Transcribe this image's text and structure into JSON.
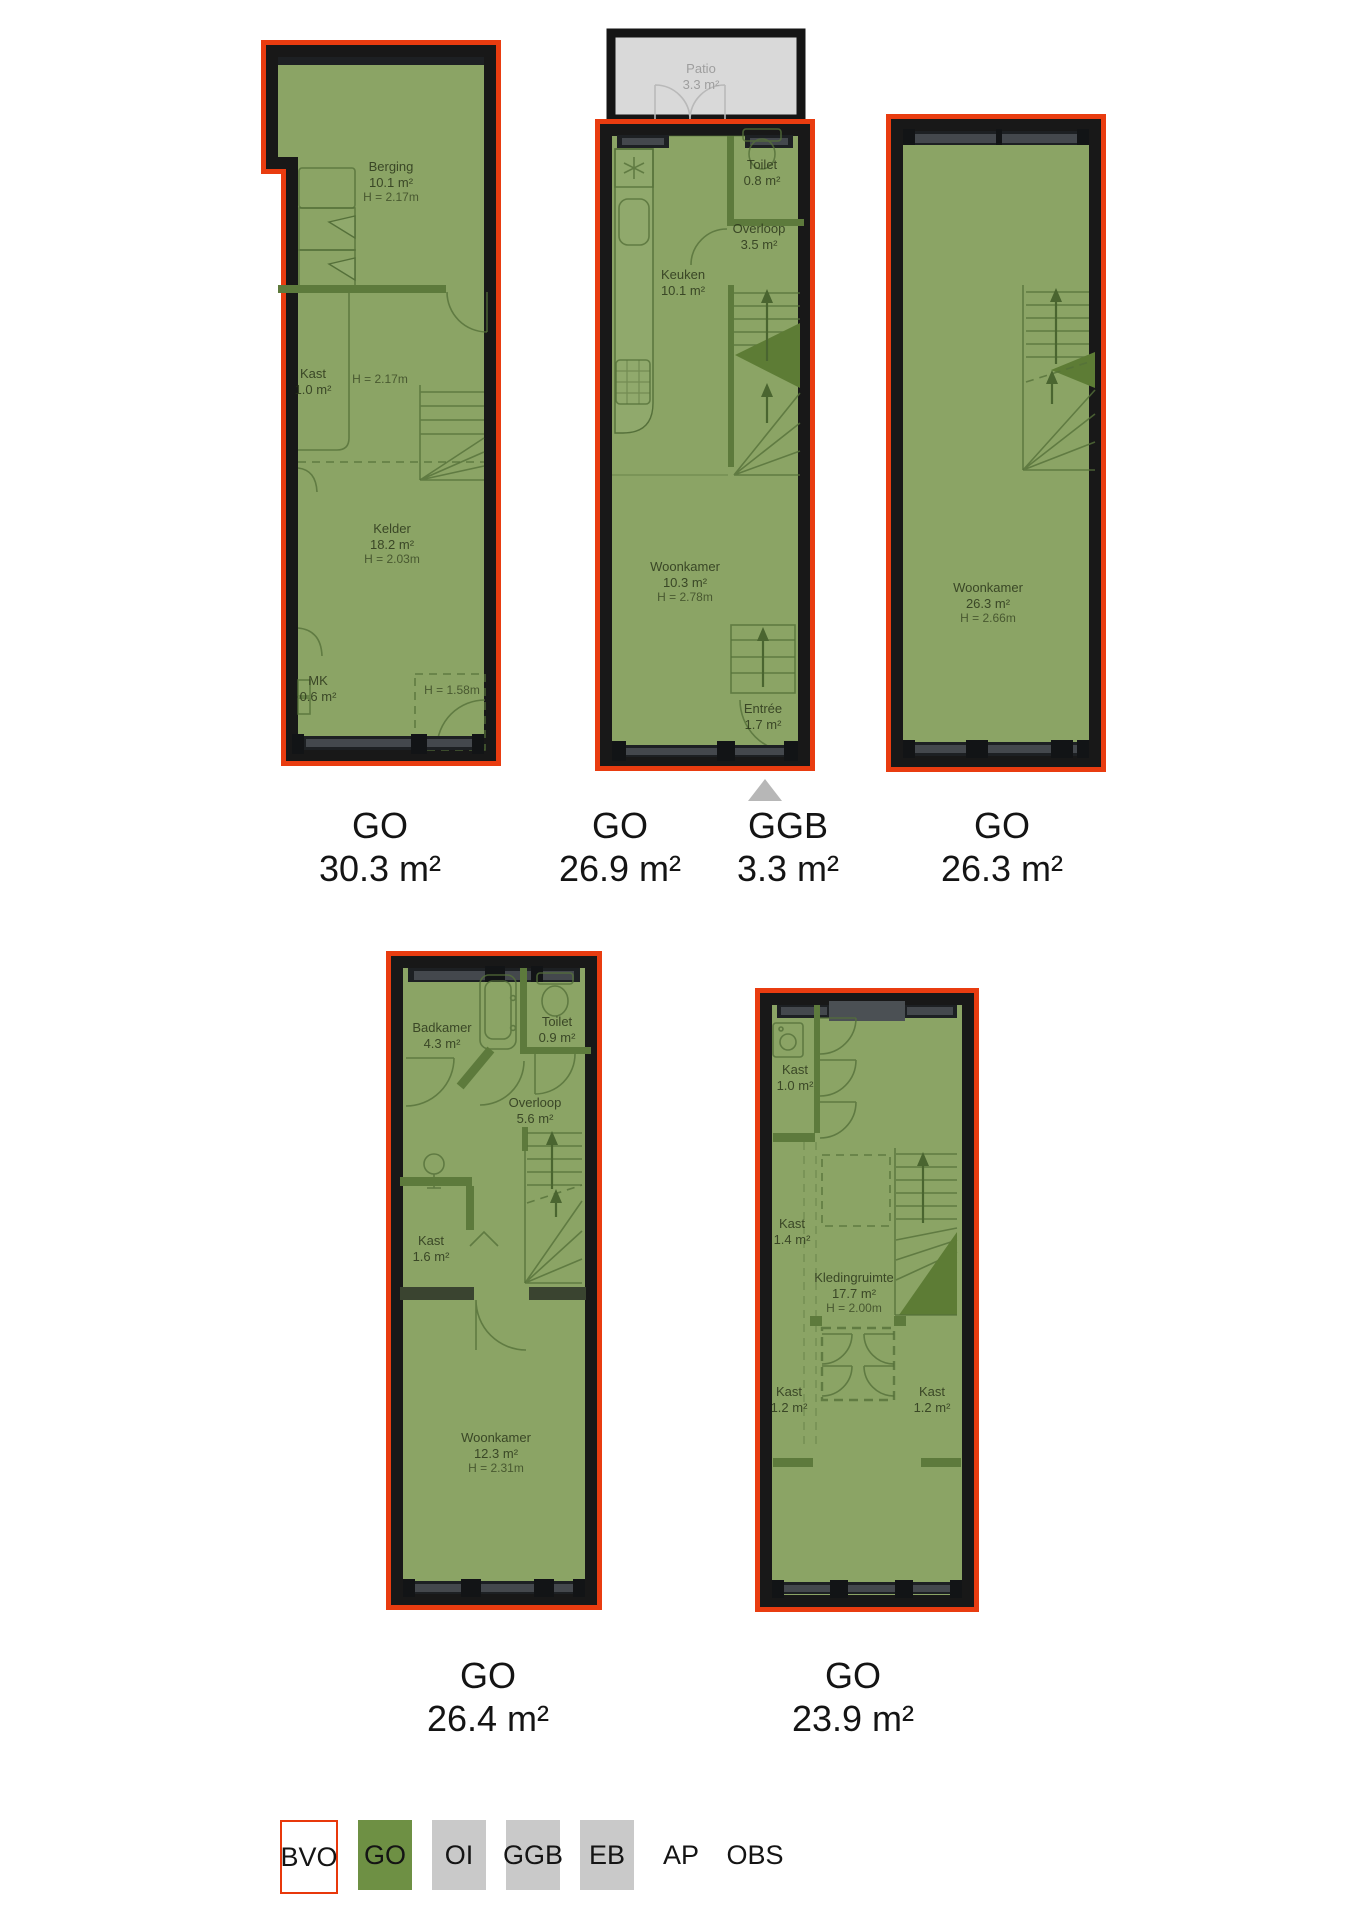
{
  "colors": {
    "outline_red": "#e93c10",
    "room_green": "#8ba465",
    "legend_green": "#6e9044",
    "legend_gray": "#c9c9c9",
    "patio_gray": "#d9d9d9",
    "wall_black": "#181818"
  },
  "plans": [
    {
      "id": "souterrain",
      "caption": {
        "tag": "GO",
        "area": "30.3 m²"
      },
      "rooms": {
        "berging": {
          "name": "Berging",
          "area": "10.1 m²",
          "height": "H = 2.17m"
        },
        "kast": {
          "name": "Kast",
          "area": "1.0 m²"
        },
        "kast_height": "H = 2.17m",
        "kelder": {
          "name": "Kelder",
          "area": "18.2 m²",
          "height": "H = 2.03m"
        },
        "mk": {
          "name": "MK",
          "area": "0.6 m²"
        },
        "low_height": "H = 1.58m"
      }
    },
    {
      "id": "begane-grond",
      "caption": {
        "tag": "GO",
        "area": "26.9 m²"
      },
      "caption2": {
        "tag": "GGB",
        "area": "3.3 m²"
      },
      "rooms": {
        "patio": {
          "name": "Patio",
          "area": "3.3 m²"
        },
        "toilet": {
          "name": "Toilet",
          "area": "0.8 m²"
        },
        "overloop": {
          "name": "Overloop",
          "area": "3.5 m²"
        },
        "keuken": {
          "name": "Keuken",
          "area": "10.1 m²"
        },
        "woonkamer": {
          "name": "Woonkamer",
          "area": "10.3 m²",
          "height": "H = 2.78m"
        },
        "entree": {
          "name": "Entrée",
          "area": "1.7 m²"
        }
      }
    },
    {
      "id": "eerste-verdieping",
      "caption": {
        "tag": "GO",
        "area": "26.3 m²"
      },
      "rooms": {
        "woonkamer": {
          "name": "Woonkamer",
          "area": "26.3 m²",
          "height": "H = 2.66m"
        }
      }
    },
    {
      "id": "tweede-verdieping",
      "caption": {
        "tag": "GO",
        "area": "26.4 m²"
      },
      "rooms": {
        "badkamer": {
          "name": "Badkamer",
          "area": "4.3 m²"
        },
        "toilet": {
          "name": "Toilet",
          "area": "0.9 m²"
        },
        "overloop": {
          "name": "Overloop",
          "area": "5.6 m²"
        },
        "kast": {
          "name": "Kast",
          "area": "1.6 m²"
        },
        "woonkamer": {
          "name": "Woonkamer",
          "area": "12.3 m²",
          "height": "H = 2.31m"
        }
      }
    },
    {
      "id": "derde-verdieping",
      "caption": {
        "tag": "GO",
        "area": "23.9 m²"
      },
      "rooms": {
        "kast1": {
          "name": "Kast",
          "area": "1.0 m²"
        },
        "kast2": {
          "name": "Kast",
          "area": "1.4 m²"
        },
        "kledingruimte": {
          "name": "Kledingruimte",
          "area": "17.7 m²",
          "height": "H = 2.00m"
        },
        "kast3": {
          "name": "Kast",
          "area": "1.2 m²"
        },
        "kast4": {
          "name": "Kast",
          "area": "1.2 m²"
        }
      }
    }
  ],
  "legend": {
    "items": [
      {
        "label": "BVO"
      },
      {
        "label": "GO"
      },
      {
        "label": "OI"
      },
      {
        "label": "GGB"
      },
      {
        "label": "EB"
      },
      {
        "label": "AP"
      },
      {
        "label": "OBS"
      }
    ]
  }
}
